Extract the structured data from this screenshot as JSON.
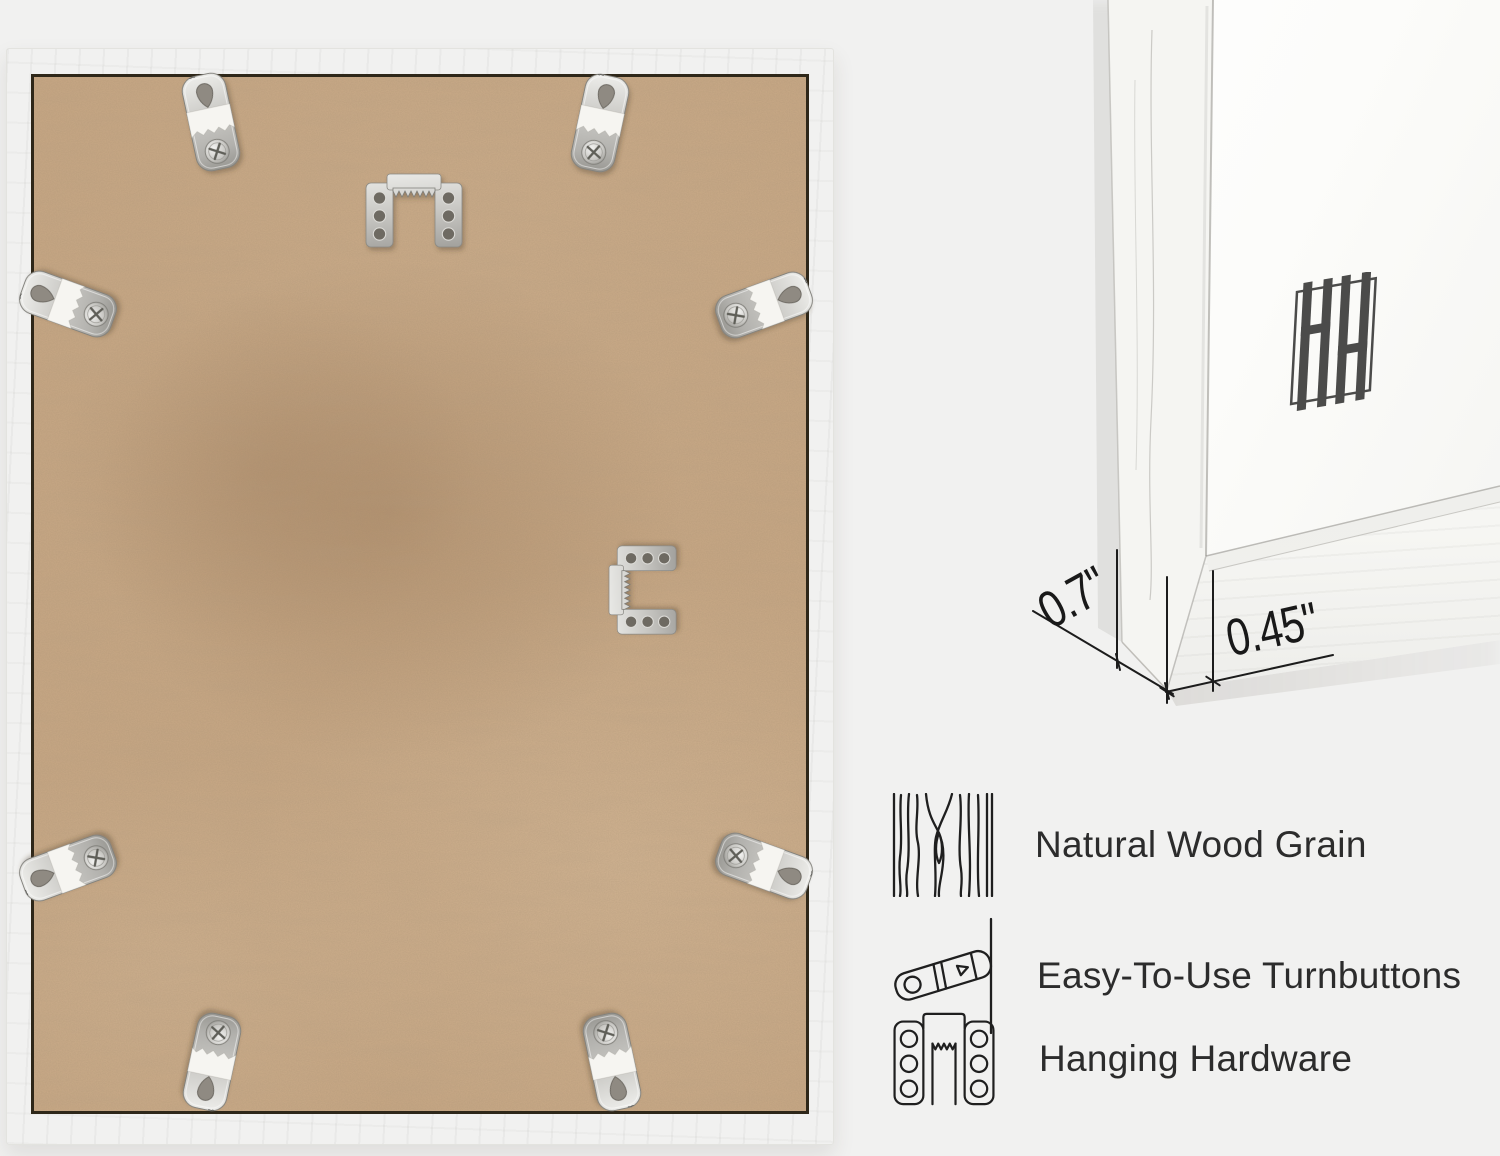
{
  "page": {
    "background": "#f1f1f0"
  },
  "frame_back_photo": {
    "frame_color": "#fbfbf8",
    "backing_color": "#c8a885",
    "seam_color": "#2e2719",
    "hardware_metal_color": "#c6c5c1",
    "turnbutton_count": 8,
    "sawtooth_hanger_count": 2
  },
  "corner_detail_photo": {
    "mat_color": "#fcfcfa",
    "logo_monogram": "HH",
    "logo_color": "#4b4b4a"
  },
  "dimensions": {
    "depth_label": "0.7\"",
    "face_width_label": "0.45\""
  },
  "features": {
    "text_color": "#2c2c2c",
    "items": [
      {
        "icon": "wood-grain-icon",
        "label": "Natural Wood Grain"
      },
      {
        "icon": "turnbutton-icon",
        "label": "Easy-To-Use Turnbuttons"
      },
      {
        "icon": "hanging-hardware-icon",
        "label": "Hanging Hardware"
      }
    ]
  }
}
